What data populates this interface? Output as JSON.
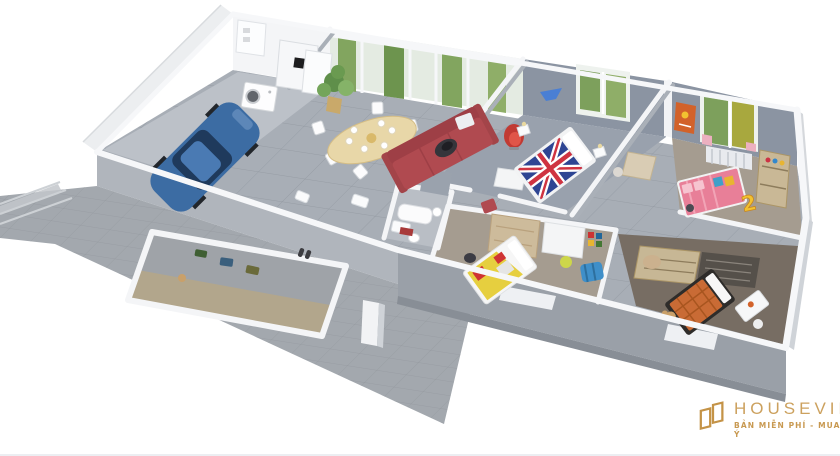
{
  "scene": {
    "type": "3d-floorplan-render",
    "rooms": [
      "garage",
      "laundry-corner",
      "dining-area",
      "living-area",
      "bedroom-unionjack",
      "bedroom-pink",
      "bathroom",
      "kids-bedroom",
      "bedroom-orange",
      "entry-patio",
      "terrace"
    ]
  },
  "watermark": {
    "brand": "HOUSEVIET",
    "tagline": "BẢN MIỄN PHÍ - MUA NHƯ Ý",
    "color": "#c49347"
  },
  "decals": {
    "kids_bed_number": "2"
  },
  "colors": {
    "car_blue": "#3c6ca3",
    "sofa_red": "#b04a50",
    "armchair_red": "#c13a33",
    "flag_blue": "#2e4593",
    "flag_red": "#cf3341",
    "bed_pink": "#e87f98",
    "bed_orange": "#c96b35",
    "bed_yellow": "#e6cf3f",
    "wall_grey": "#8b94a2",
    "tile_grey": "#a8aeb6",
    "terrace_grey": "#a3a8ae",
    "wood": "#c7b795",
    "foliage_green": "#7da05c"
  }
}
